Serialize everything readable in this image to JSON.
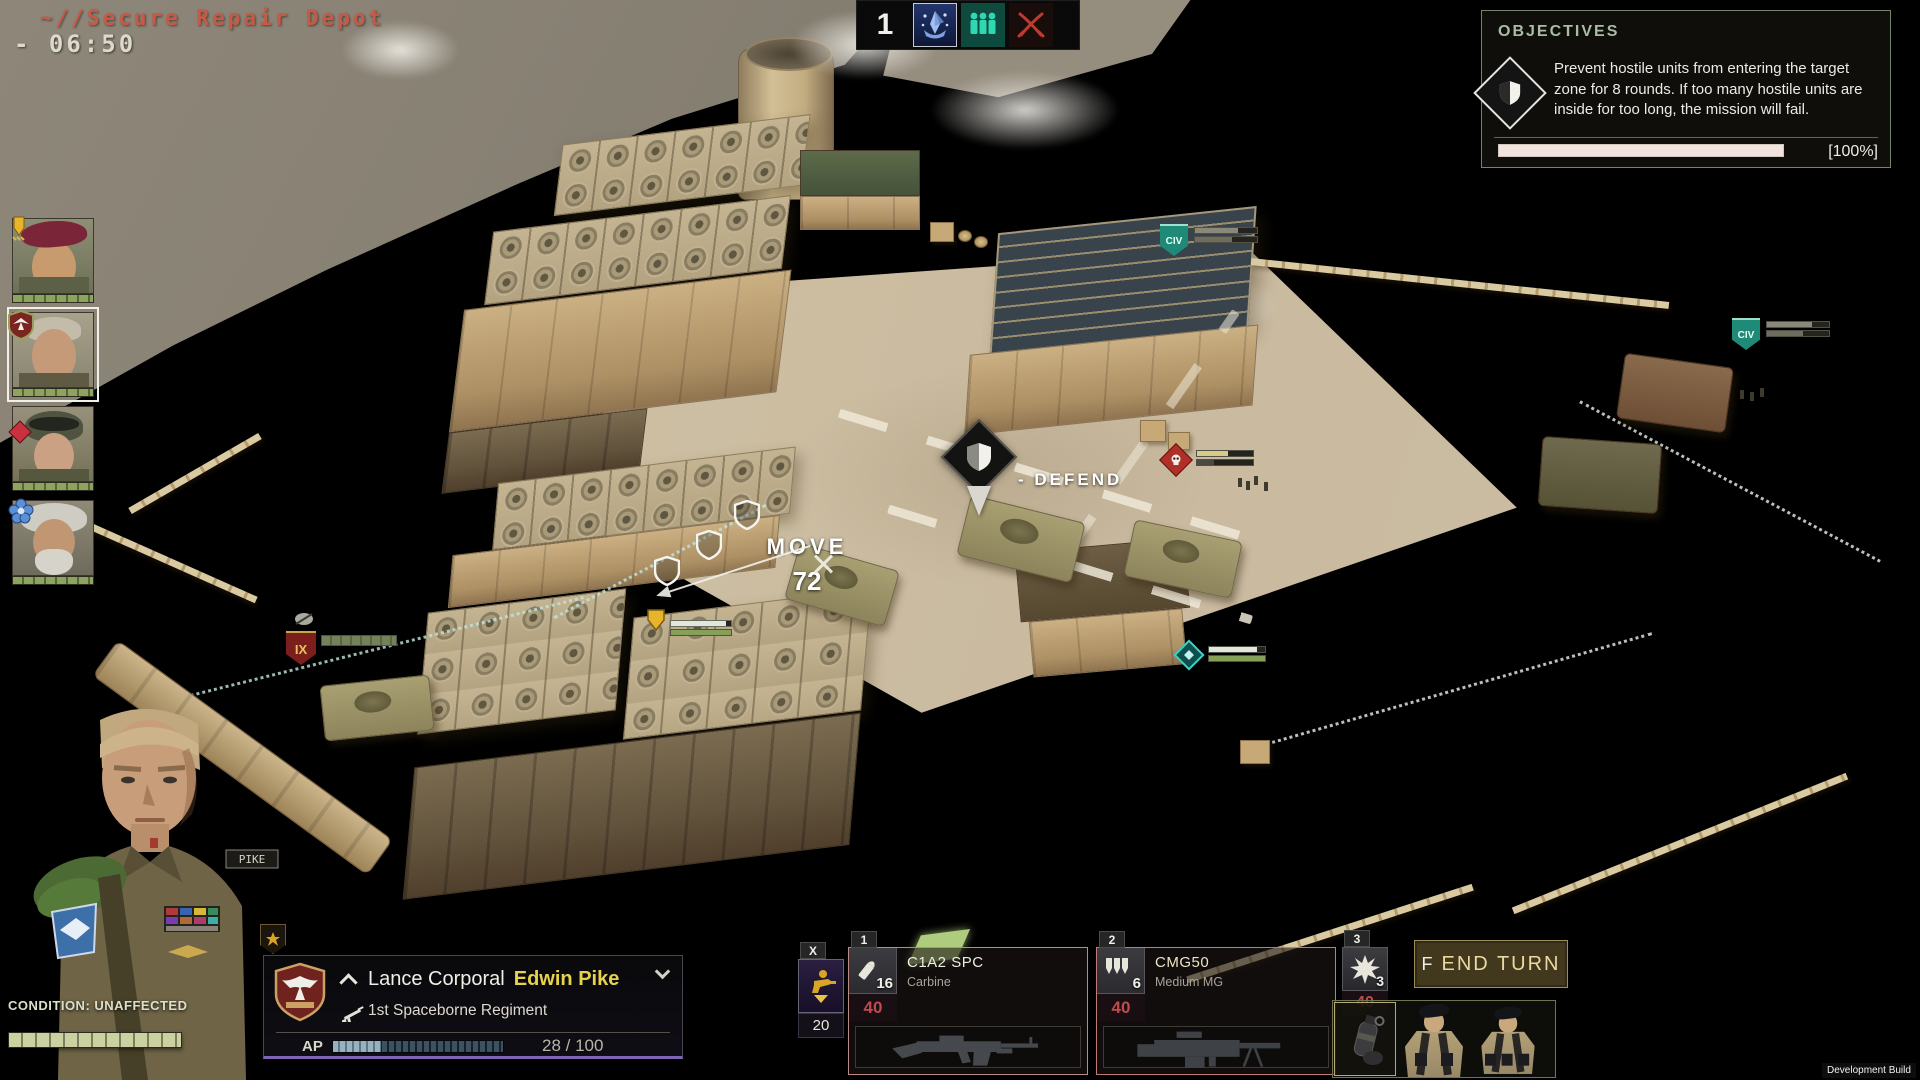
{
  "header": {
    "mission_title": "~//Secure Repair Depot",
    "timer": "- 06:50",
    "turn_number": "1",
    "turn_icons": [
      "faction-emblem-icon",
      "civilians-icon",
      "crossed-sabers-combat-icon"
    ]
  },
  "objectives": {
    "title": "OBJECTIVES",
    "icon": "defend-shield-icon",
    "description": "Prevent hostile units from entering the target zone for 8 rounds. If too many hostile units are inside for too long, the mission will fail.",
    "progress_label": "[100%]",
    "progress_percent": 100
  },
  "squad": {
    "members": [
      {
        "id": 1,
        "badge": "jump-arrow-badge",
        "hp_percent": 100,
        "selected": false
      },
      {
        "id": 2,
        "badge": "spaceborne-eagle-badge",
        "hp_percent": 100,
        "selected": true
      },
      {
        "id": 3,
        "badge": "red-diamond-badge",
        "tags": [
          "SU",
          "SU"
        ],
        "hp_percent": 100,
        "selected": false
      },
      {
        "id": 4,
        "badge": "blue-flower-badge",
        "hp_percent": 100,
        "selected": false
      }
    ]
  },
  "map": {
    "defend_label": "- DEFEND",
    "move_label": "MOVE",
    "move_cost": "72",
    "civ_label": "CIV",
    "enemy_label": "IX",
    "markers": [
      "defend-marker",
      "move-indicator",
      "selected-unit-marker",
      "civilian-marker",
      "civilian-marker",
      "enemy-ix-marker",
      "hostile-skull-marker",
      "ally-diamond-marker"
    ]
  },
  "character": {
    "nametag": "PIKE",
    "condition_label": "CONDITION: UNAFFECTED",
    "rank": "Lance Corporal",
    "name": "Edwin Pike",
    "regiment": "1st Spaceborne Regiment",
    "ap_label": "AP",
    "ap_value": "28 / 100",
    "ap_current": 28,
    "ap_max": 100
  },
  "ability": {
    "hotkey": "X",
    "cost": "20",
    "icon": "overwatch-soldier-icon"
  },
  "weapons": [
    {
      "hotkey": "1",
      "ammo": "16",
      "reserve": "40",
      "name": "C1A2 SPC",
      "type": "Carbine",
      "icon": "bullet-icon"
    },
    {
      "hotkey": "2",
      "ammo": "6",
      "reserve": "40",
      "name": "CMG50",
      "type": "Medium MG",
      "icon": "burst-arrows-icon"
    },
    {
      "hotkey": "3",
      "count": "3",
      "reserve": "40",
      "icon": "explosion-icon",
      "item": "grenade"
    }
  ],
  "end_turn": {
    "hotkey": "F",
    "label": "END TURN"
  },
  "footer": {
    "dev_build": "Development Build"
  },
  "colors": {
    "title_red": "#c55a47",
    "name_yellow": "#e7d24b",
    "ammo_red": "#c04a50",
    "hp_green": "#8ea35e",
    "teal": "#2fd8b2",
    "accent_purple": "#7e64b4",
    "sage": "#a9bca4",
    "end_turn_gold": "#ecd9a1"
  }
}
